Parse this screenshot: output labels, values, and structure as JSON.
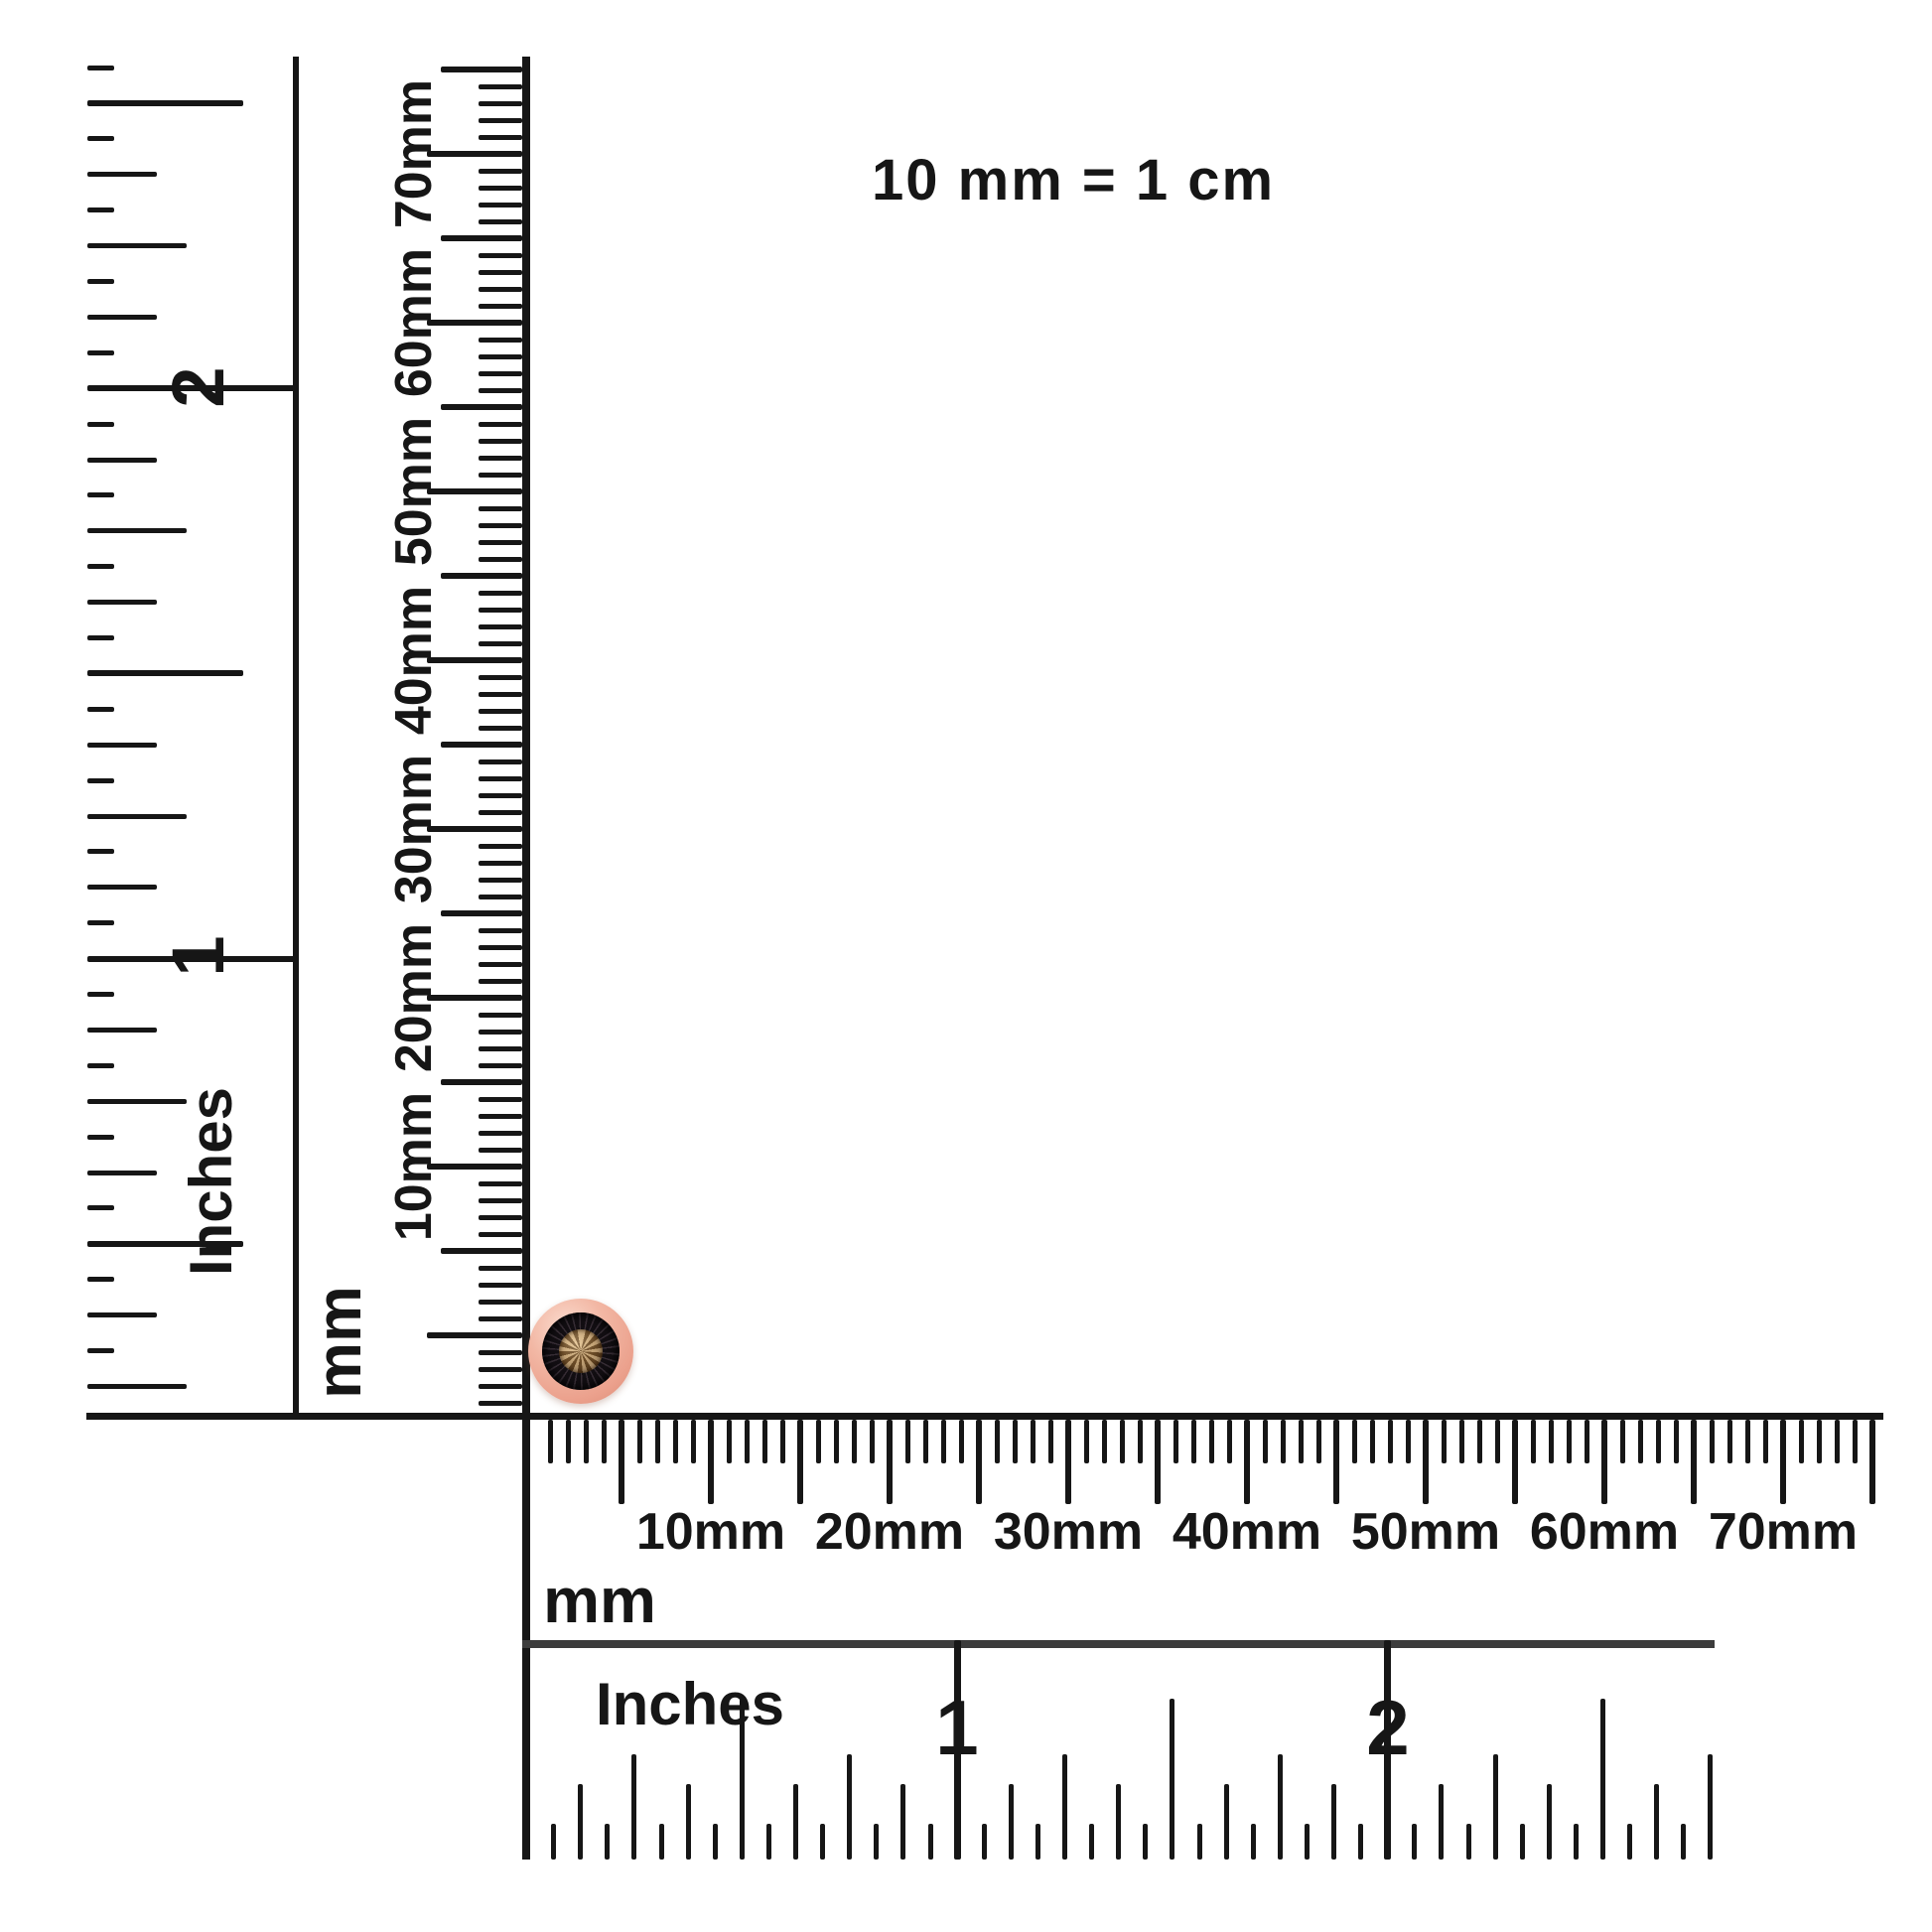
{
  "scale_note": "10 mm = 1 cm",
  "rulers": {
    "left_inches": {
      "unit": "Inches",
      "majors": [
        "2",
        "1"
      ]
    },
    "left_mm": {
      "unit": "mm",
      "majors": [
        "70mm",
        "60mm",
        "50mm",
        "40mm",
        "30mm",
        "20mm",
        "10mm"
      ]
    },
    "bottom_mm": {
      "unit": "mm",
      "majors": [
        "10mm",
        "20mm",
        "30mm",
        "40mm",
        "50mm",
        "60mm",
        "70mm"
      ]
    },
    "bottom_inches": {
      "unit": "Inches",
      "majors": [
        "1",
        "2"
      ]
    }
  },
  "product": {
    "description": "round champagne diamond stud earring in rose-gold bezel with black faceted halo, shown at ruler corner for scale",
    "colors": {
      "rose_gold": "#f2b7a4",
      "rose_gold_highlight": "#fbdccf",
      "black_setting": "#120e12",
      "champagne_stone": "#9a7240"
    }
  },
  "colors": {
    "ink": "#161616",
    "inch_ruler_line": "#3c3c3c",
    "background": "#ffffff"
  }
}
